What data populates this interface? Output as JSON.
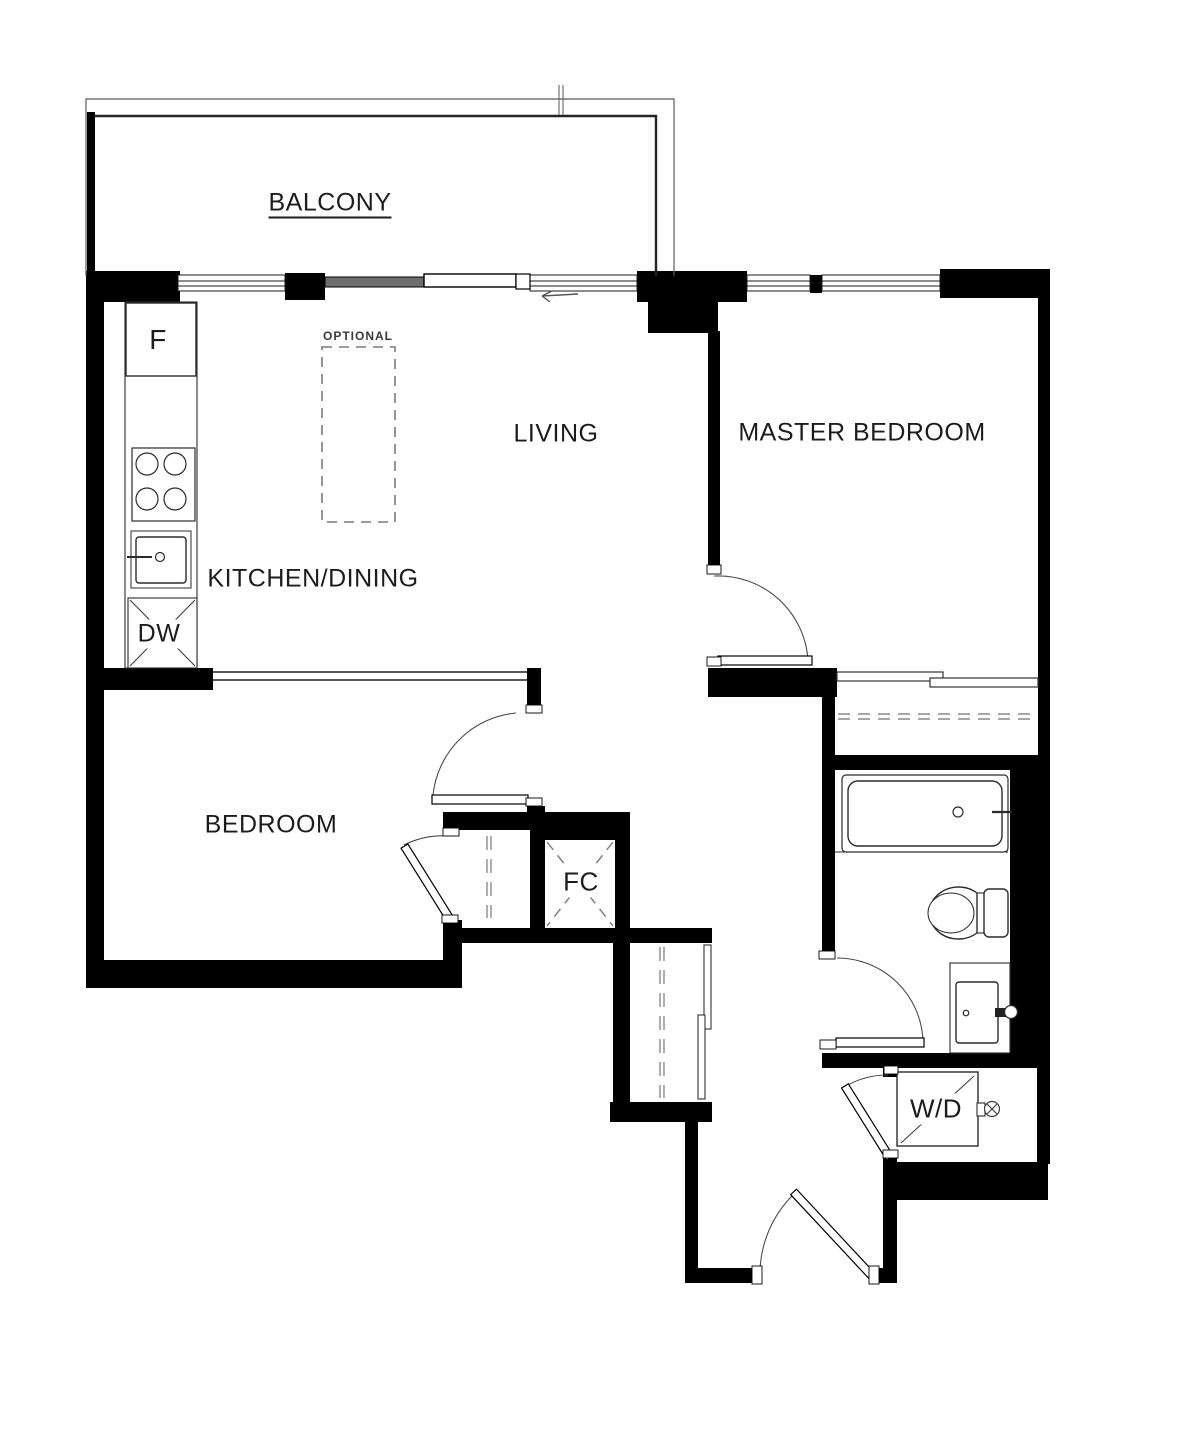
{
  "plan": {
    "title": "2-bedroom apartment floor plan",
    "rooms": {
      "balcony": {
        "label": "BALCONY"
      },
      "living": {
        "label": "LIVING"
      },
      "master_bedroom": {
        "label": "MASTER BEDROOM"
      },
      "kitchen_dining": {
        "label": "KITCHEN/DINING"
      },
      "bedroom": {
        "label": "BEDROOM"
      }
    },
    "fixtures": {
      "island_note": {
        "label": "OPTIONAL"
      },
      "fridge": {
        "label": "F"
      },
      "dishwasher": {
        "label": "DW"
      },
      "foyer_closet": {
        "label": "FC"
      },
      "washer_dryer": {
        "label": "W/D"
      }
    },
    "colors": {
      "wall": "#000000",
      "line": "#2b2b2b",
      "arc": "#4a4a4a",
      "dash": "#8a8a8a",
      "slider_panel": "#6e6e6e",
      "background": "#ffffff"
    }
  }
}
